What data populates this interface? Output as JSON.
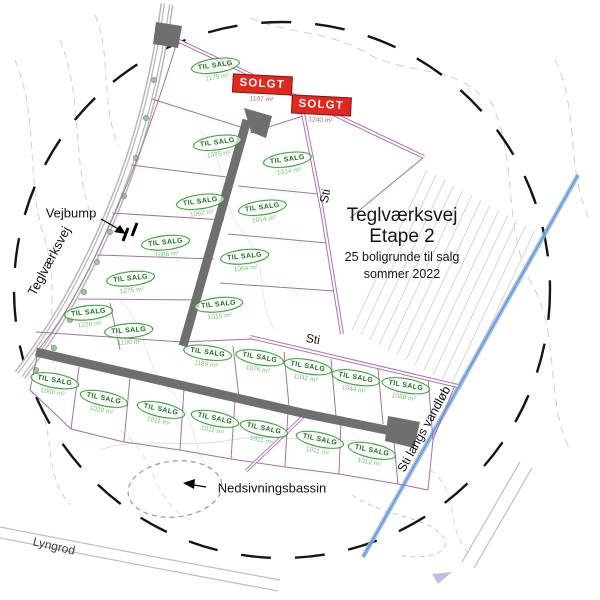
{
  "map": {
    "title": {
      "line1": "Teglværksvej",
      "line2": "Etape 2",
      "line3": "25 boligrunde til salg",
      "line4": "sommer 2022"
    },
    "labels": {
      "vejbump": "Vejbump",
      "road_name": "Teglværksvej",
      "path_upper": "Sti",
      "path_lower": "Sti",
      "path_stream": "Sti langs vandløb",
      "basin": "Nedsivningsbassin",
      "bottom_road": "Lyngrod"
    },
    "status_labels": {
      "for_sale": "TIL SALG",
      "sold": "SOLGT"
    },
    "colors": {
      "for_sale_green": "#2e9e2e",
      "sold_red": "#e0281e",
      "path_purple": "#b070b0",
      "road_gray": "#6f6f6f",
      "stream_blue": "#7fabdf"
    },
    "plots": [
      {
        "id": 1,
        "status": "til_salg",
        "area": "1175 m²",
        "x": 216,
        "y": 70,
        "tilt": -8
      },
      {
        "id": 2,
        "status": "solgt",
        "area": "1107 m²",
        "x": 262,
        "y": 89,
        "tilt": 3
      },
      {
        "id": 3,
        "status": "solgt",
        "area": "1240 m²",
        "x": 321,
        "y": 110,
        "tilt": 3
      },
      {
        "id": 4,
        "status": "til_salg",
        "area": "1075 m²",
        "x": 218,
        "y": 147,
        "tilt": -8
      },
      {
        "id": 5,
        "status": "til_salg",
        "area": "1014 m²",
        "x": 288,
        "y": 164,
        "tilt": -8
      },
      {
        "id": 6,
        "status": "til_salg",
        "area": "1092 m²",
        "x": 201,
        "y": 206,
        "tilt": -8
      },
      {
        "id": 7,
        "status": "til_salg",
        "area": "1014 m²",
        "x": 263,
        "y": 212,
        "tilt": -8
      },
      {
        "id": 8,
        "status": "til_salg",
        "area": "1086 m²",
        "x": 166,
        "y": 247,
        "tilt": -6
      },
      {
        "id": 9,
        "status": "til_salg",
        "area": "1064 m²",
        "x": 245,
        "y": 261,
        "tilt": -6
      },
      {
        "id": 10,
        "status": "til_salg",
        "area": "1275 m²",
        "x": 131,
        "y": 283,
        "tilt": -6
      },
      {
        "id": 11,
        "status": "til_salg",
        "area": "1226 m²",
        "x": 89,
        "y": 317,
        "tilt": -6
      },
      {
        "id": 12,
        "status": "til_salg",
        "area": "1015 m²",
        "x": 219,
        "y": 309,
        "tilt": -6
      },
      {
        "id": 13,
        "status": "til_salg",
        "area": "1100 m²",
        "x": 129,
        "y": 335,
        "tilt": -4
      },
      {
        "id": 14,
        "status": "til_salg",
        "area": "1189 m²",
        "x": 207,
        "y": 357,
        "tilt": 8
      },
      {
        "id": 15,
        "status": "til_salg",
        "area": "1076 m²",
        "x": 259,
        "y": 362,
        "tilt": 10
      },
      {
        "id": 16,
        "status": "til_salg",
        "area": "1042 m²",
        "x": 307,
        "y": 371,
        "tilt": 10
      },
      {
        "id": 17,
        "status": "til_salg",
        "area": "1044 m²",
        "x": 355,
        "y": 382,
        "tilt": 10
      },
      {
        "id": 18,
        "status": "til_salg",
        "area": "1088 m²",
        "x": 405,
        "y": 390,
        "tilt": 10
      },
      {
        "id": 19,
        "status": "til_salg",
        "area": "1060 m²",
        "x": 54,
        "y": 385,
        "tilt": 10
      },
      {
        "id": 20,
        "status": "til_salg",
        "area": "1020 m²",
        "x": 103,
        "y": 403,
        "tilt": 12
      },
      {
        "id": 21,
        "status": "til_salg",
        "area": "1011 m²",
        "x": 160,
        "y": 414,
        "tilt": 12
      },
      {
        "id": 22,
        "status": "til_salg",
        "area": "1011 m²",
        "x": 214,
        "y": 423,
        "tilt": 12
      },
      {
        "id": 23,
        "status": "til_salg",
        "area": "1011 m²",
        "x": 263,
        "y": 433,
        "tilt": 12
      },
      {
        "id": 24,
        "status": "til_salg",
        "area": "1011 m²",
        "x": 319,
        "y": 444,
        "tilt": 12
      },
      {
        "id": 25,
        "status": "til_salg",
        "area": "1012 m²",
        "x": 371,
        "y": 455,
        "tilt": 12
      }
    ]
  }
}
